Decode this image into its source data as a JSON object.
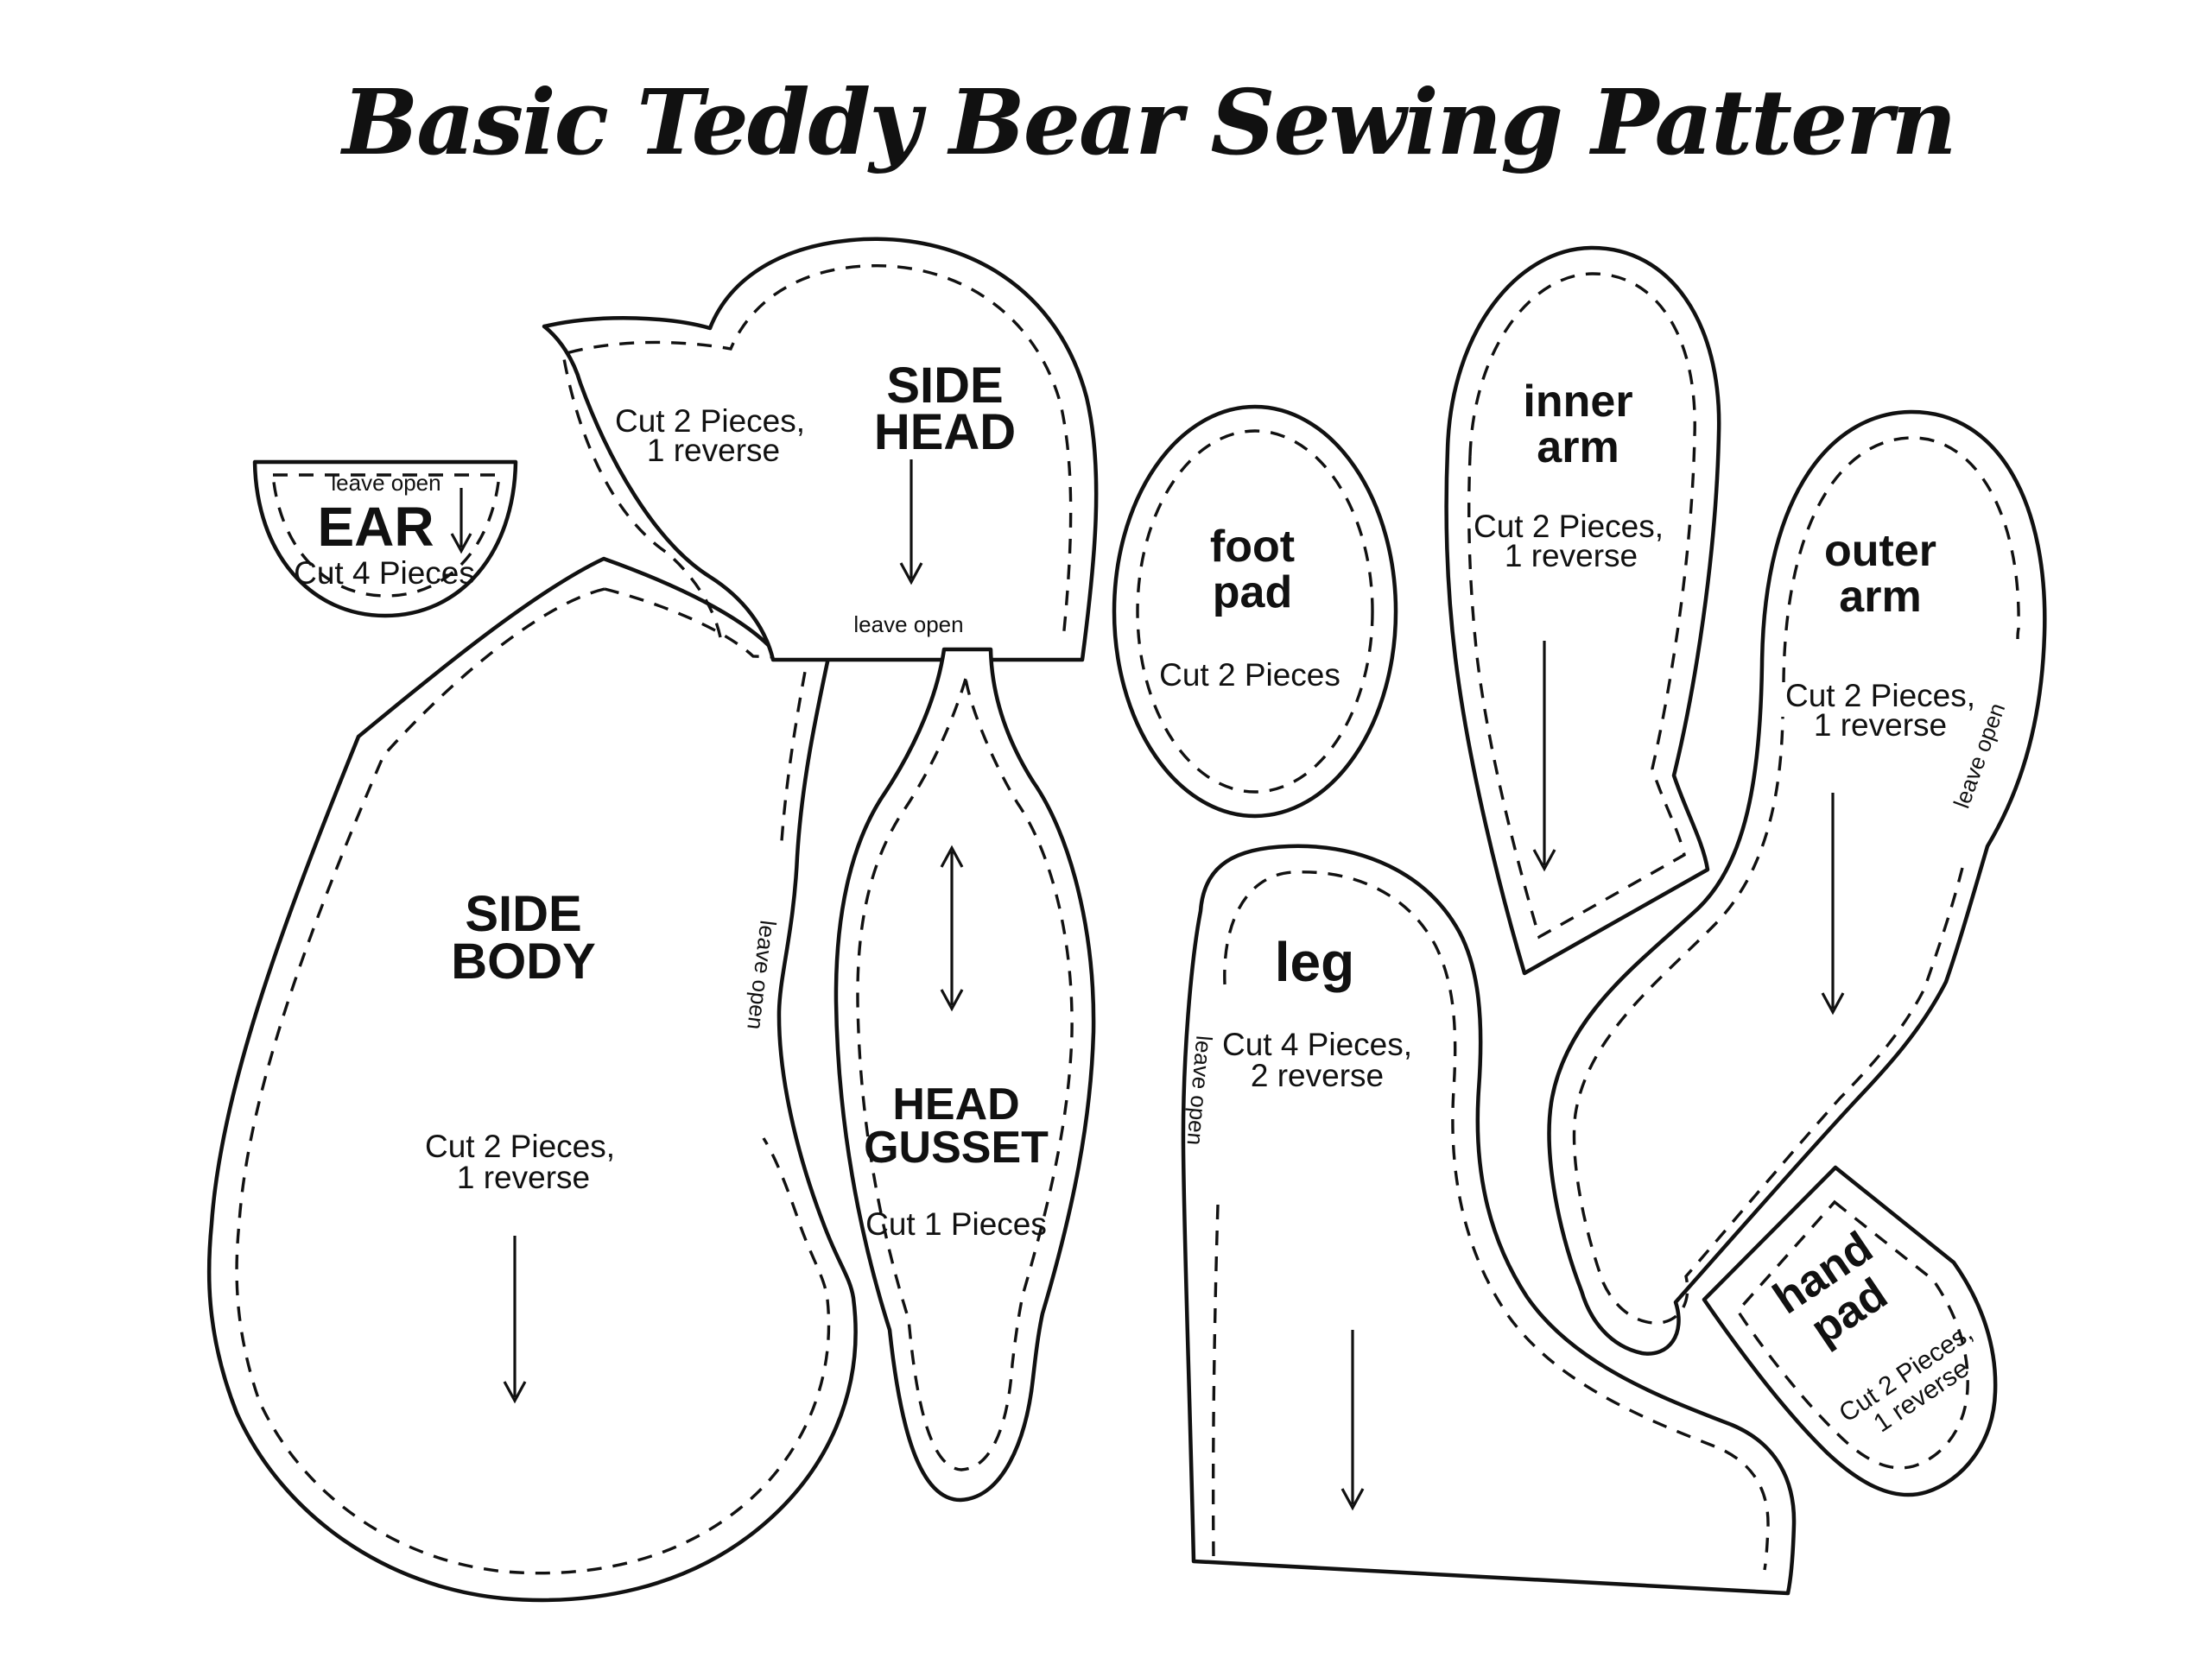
{
  "title": "Basic Teddy Bear Sewing Pattern",
  "colors": {
    "ink": "#111111",
    "paper": "#ffffff"
  },
  "pieces": {
    "ear": {
      "label": "EAR",
      "cut": "Cut 4 Pieces",
      "note": "leave open"
    },
    "side_head": {
      "label_line1": "SIDE",
      "label_line2": "HEAD",
      "cut_line1": "Cut 2 Pieces,",
      "cut_line2": "1 reverse",
      "note": "leave open"
    },
    "side_body": {
      "label_line1": "SIDE",
      "label_line2": "BODY",
      "cut_line1": "Cut 2 Pieces,",
      "cut_line2": "1 reverse",
      "note": "leave open"
    },
    "head_gusset": {
      "label_line1": "HEAD",
      "label_line2": "GUSSET",
      "cut": "Cut 1 Pieces"
    },
    "foot_pad": {
      "label_line1": "foot",
      "label_line2": "pad",
      "cut": "Cut 2 Pieces"
    },
    "leg": {
      "label": "leg",
      "cut_line1": "Cut 4 Pieces,",
      "cut_line2": "2 reverse",
      "note": "leave open"
    },
    "inner_arm": {
      "label_line1": "inner",
      "label_line2": "arm",
      "cut_line1": "Cut 2 Pieces,",
      "cut_line2": "1 reverse"
    },
    "outer_arm": {
      "label_line1": "outer",
      "label_line2": "arm",
      "cut_line1": "Cut 2 Pieces,",
      "cut_line2": "1 reverse",
      "note": "leave open"
    },
    "hand_pad": {
      "label_line1": "hand",
      "label_line2": "pad",
      "cut_line1": "Cut 2 Pieces,",
      "cut_line2": "1 reverse"
    }
  }
}
